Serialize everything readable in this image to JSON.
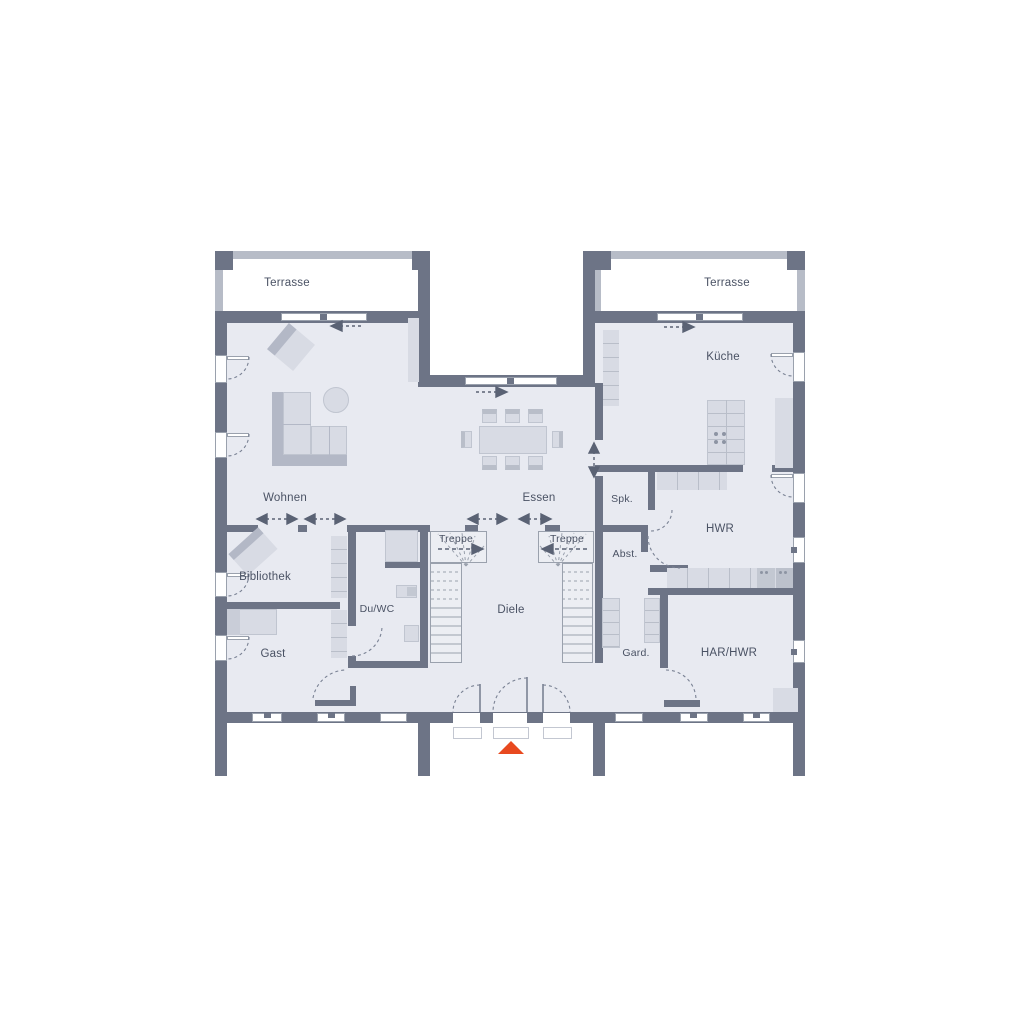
{
  "plan": {
    "title": "Erdgeschoss Grundriss",
    "rooms": {
      "terrasse_left": {
        "label": "Terrasse"
      },
      "terrasse_right": {
        "label": "Terrasse"
      },
      "wohnen": {
        "label": "Wohnen"
      },
      "essen": {
        "label": "Essen"
      },
      "kueche": {
        "label": "Küche"
      },
      "bibliothek": {
        "label": "Bibliothek"
      },
      "gast": {
        "label": "Gast"
      },
      "du_wc": {
        "label": "Du/WC"
      },
      "treppe_left": {
        "label": "Treppe"
      },
      "treppe_right": {
        "label": "Treppe"
      },
      "diele": {
        "label": "Diele"
      },
      "spk": {
        "label": "Spk."
      },
      "abst": {
        "label": "Abst."
      },
      "hwr": {
        "label": "HWR"
      },
      "gard": {
        "label": "Gard."
      },
      "har_hwr": {
        "label": "HAR/HWR"
      }
    },
    "markers": {
      "entrance_marker": "red-triangle",
      "entrance_marker_color": "#e8491f"
    },
    "colors": {
      "wall": "#6d7486",
      "floor": "#e8eaf1",
      "furniture": "#d8dbe4",
      "terrace_band": "#b7bcc7",
      "annotation": "#7a8294",
      "text": "#4a5264"
    }
  }
}
